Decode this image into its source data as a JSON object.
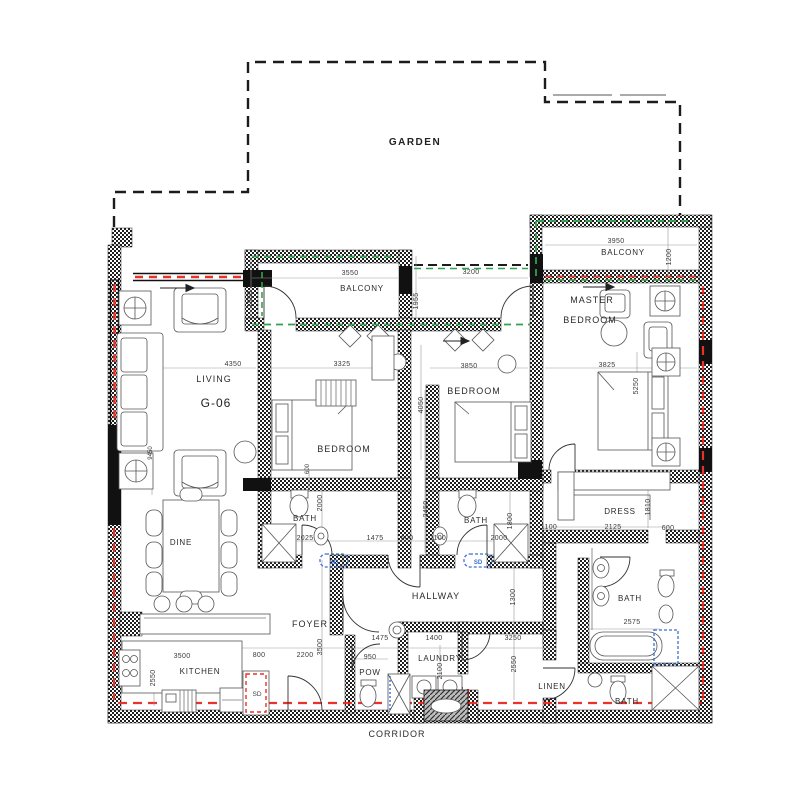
{
  "labels": {
    "garden": "GARDEN",
    "balcony": "BALCONY",
    "master_line1": "MASTER",
    "master_line2": "BEDROOM",
    "living": "LIVING",
    "unit": "G-06",
    "bedroom": "BEDROOM",
    "bath": "BATH",
    "dress": "DRESS",
    "hallway": "HALLWAY",
    "foyer": "FOYER",
    "kitchen": "KITCHEN",
    "dine": "DINE",
    "laundry": "LAUNDRY",
    "pow": "POW",
    "linen": "LINEN",
    "corridor": "CORRIDOR",
    "sd": "SD"
  },
  "dims": {
    "d3550": "3550",
    "d3200": "3200",
    "d3950": "3950",
    "d1950": "1950",
    "d1955": "1955",
    "d1200": "1200",
    "d4350": "4350",
    "d9450": "9450",
    "d3325": "3325",
    "d4050": "4050",
    "d3850": "3850",
    "d3825": "3825",
    "d5250": "5250",
    "d2025": "2025",
    "d1475": "1475",
    "d600": "600",
    "d1100": "1100",
    "d2000": "2000",
    "d2450": "2450",
    "d1800": "1800",
    "d2125": "2125",
    "d1810": "1810",
    "d2575": "2575",
    "d1300": "1300",
    "d3500": "3500",
    "d2200": "2200",
    "d800": "800",
    "d950": "950",
    "d1400": "1400",
    "d3250": "3250",
    "d2550": "2550",
    "d2100": "2100"
  },
  "colors": {
    "wall": "#1a1a1a",
    "fire_line": "#e8322a",
    "glass_line": "#2fa349",
    "sd_box": "#3b6fd4",
    "dim_text": "#3a3a3a"
  }
}
